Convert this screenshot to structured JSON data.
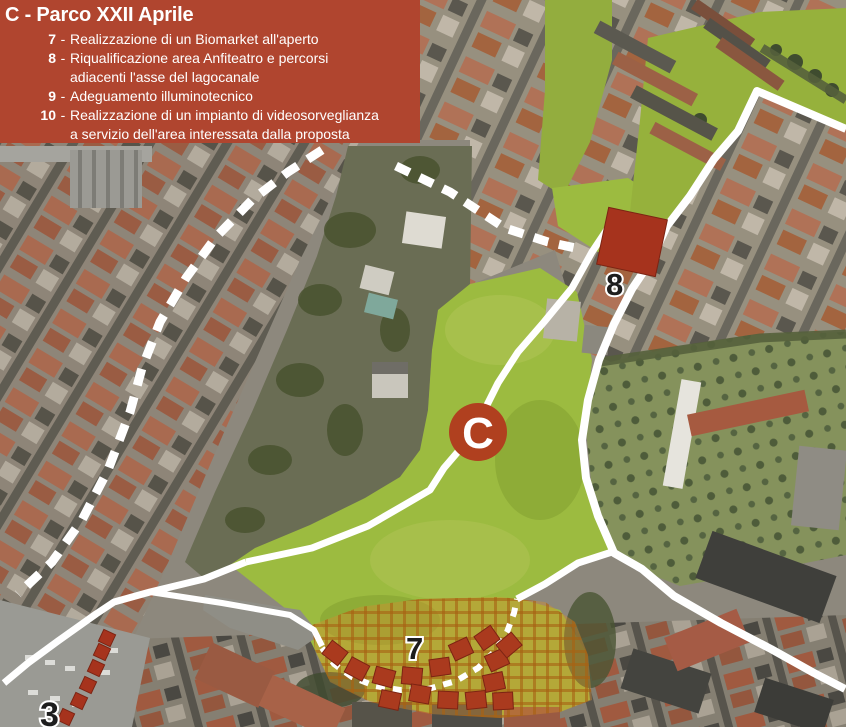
{
  "legend": {
    "title": "C - Parco XXII Aprile",
    "items": [
      {
        "num": "7",
        "sep": "-",
        "line1": "Realizzazione di un Biomarket all'aperto",
        "line2": ""
      },
      {
        "num": "8",
        "sep": "-",
        "line1": "Riqualificazione area Anfiteatro e percorsi",
        "line2": "adiacenti l'asse del lagocanale"
      },
      {
        "num": "9",
        "sep": "-",
        "line1": "Adeguamento illuminotecnico",
        "line2": ""
      },
      {
        "num": "10",
        "sep": "-",
        "line1": "Realizzazione di un impianto di videosorveglianza",
        "line2": "a servizio dell'area interessata dalla proposta"
      }
    ]
  },
  "map": {
    "area_marker": {
      "label": "C"
    },
    "marker_anfiteatro": {
      "label": "8"
    },
    "marker_biomarket": {
      "label": "7"
    },
    "marker_route": {
      "label": "3"
    },
    "colors": {
      "legend_bg": "#b0452f",
      "proposal_red": "#a6331d",
      "park_green": "#9cbb40",
      "hatch_orange": "#cf8a1e",
      "path_white": "#ffffff"
    }
  }
}
